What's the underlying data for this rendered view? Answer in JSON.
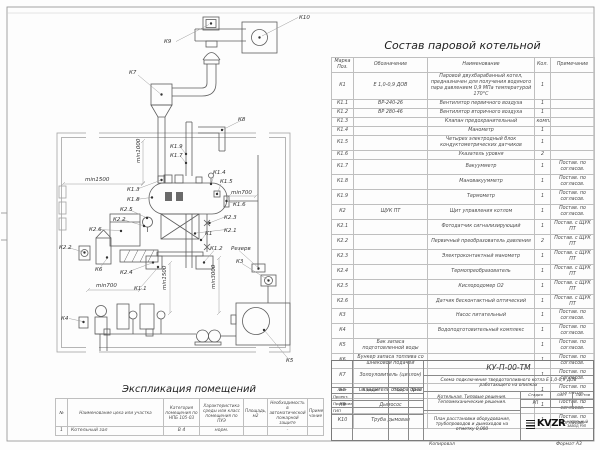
{
  "diagram": {
    "labels": {
      "k10": "К10",
      "k9": "К9",
      "k7": "К7",
      "k8": "К8",
      "k19": "К1.9",
      "k17": "К1.7",
      "k13": "К1.3",
      "k18": "К1.8",
      "k25": "К2.5",
      "k22a": "К2.2",
      "k14": "К1.4",
      "k15": "К1.5",
      "k16": "К1.6",
      "k23": "К2.3",
      "k21": "К2.1",
      "k1": "К1",
      "k26": "К2.6",
      "k22b": "К2.2",
      "k6": "К6",
      "k24": "К2.4",
      "k11": "К1.1",
      "k12": "К1.2",
      "rezerv": "Резерв",
      "k3": "К3",
      "k4": "К4",
      "k5": "К5",
      "dim_min1000": "min1000",
      "dim_min1500a": "min1500",
      "dim_min700a": "min700",
      "dim_min700b": "min700",
      "dim_min1500b": "min1500",
      "dim_min3000": "min3000"
    }
  },
  "composition": {
    "title": "Состав паровой котельной",
    "headers": {
      "pos": "Марка Поз.",
      "des": "Обозначение",
      "name": "Наименование",
      "qty": "Кол.",
      "note": "Примечание"
    },
    "rows": [
      {
        "pos": "К1",
        "des": "Е 1,0-0,9 ДОВ",
        "name": "Паровой двухбарабанный котел, предназначен для получения водяного пара давлением 0,9 МПа температурой 170°С",
        "qty": "1",
        "note": ""
      },
      {
        "pos": "К1.1",
        "des": "ВР-240-26",
        "name": "Вентилятор первичного воздуха",
        "qty": "1",
        "note": ""
      },
      {
        "pos": "К1.2",
        "des": "ВР 280-46",
        "name": "Вентилятор вторичного воздуха",
        "qty": "1",
        "note": ""
      },
      {
        "pos": "К1.3",
        "des": "",
        "name": "Клапан предохранительный",
        "qty": "компл.",
        "note": ""
      },
      {
        "pos": "К1.4",
        "des": "",
        "name": "Манометр",
        "qty": "1",
        "note": ""
      },
      {
        "pos": "К1.5",
        "des": "",
        "name": "Четырех электродный блок кондуктометрических датчиков",
        "qty": "1",
        "note": ""
      },
      {
        "pos": "К1.6",
        "des": "",
        "name": "Указатель уровня",
        "qty": "2",
        "note": ""
      },
      {
        "pos": "К1.7",
        "des": "",
        "name": "Вакуумметр",
        "qty": "1",
        "note": "Постав. по согласов."
      },
      {
        "pos": "К1.8",
        "des": "",
        "name": "Мановакуумметр",
        "qty": "1",
        "note": "Постав. по согласов."
      },
      {
        "pos": "К1.9",
        "des": "",
        "name": "Термометр",
        "qty": "1",
        "note": "Постав. по согласов."
      },
      {
        "pos": "К2",
        "des": "ЩУК ПТ",
        "name": "Щит управления котлом",
        "qty": "1",
        "note": "Постав. по согласов."
      },
      {
        "pos": "К2.1",
        "des": "",
        "name": "Фотодатчик сигнализирующий",
        "qty": "1",
        "note": "Постав. с ЩУК ПТ"
      },
      {
        "pos": "К2.2",
        "des": "",
        "name": "Первичный преобразователь давления",
        "qty": "2",
        "note": "Постав. с ЩУК ПТ"
      },
      {
        "pos": "К2.3",
        "des": "",
        "name": "Электроконтактный манометр",
        "qty": "1",
        "note": "Постав. с ЩУК ПТ"
      },
      {
        "pos": "К2.4",
        "des": "",
        "name": "Термопреобразователь",
        "qty": "1",
        "note": "Постав. с ЩУК ПТ"
      },
      {
        "pos": "К2.5",
        "des": "",
        "name": "Кислородомер О2",
        "qty": "1",
        "note": "Постав. с ЩУК ПТ"
      },
      {
        "pos": "К2.6",
        "des": "",
        "name": "Датчик бесконтактный оптический",
        "qty": "1",
        "note": "Постав. с ЩУК ПТ"
      },
      {
        "pos": "К3",
        "des": "",
        "name": "Насос питательный",
        "qty": "1",
        "note": "Постав. по согласов."
      },
      {
        "pos": "К4",
        "des": "",
        "name": "Водоподготовительный комплекс",
        "qty": "1",
        "note": "Постав. по согласов."
      },
      {
        "pos": "К5",
        "des": "Бак запаса подготовленной воды",
        "name": "",
        "qty": "1",
        "note": "Постав. по согласов."
      },
      {
        "pos": "К6",
        "des": "Бункер запаса топлива со шнековой подачей",
        "name": "",
        "qty": "1",
        "note": "Постав. по согласов."
      },
      {
        "pos": "К7",
        "des": "Золоуловитель (циклон)",
        "name": "",
        "qty": "1",
        "note": "Постав. по согласов."
      },
      {
        "pos": "К8",
        "des": "Охладитель отбора проб",
        "name": "",
        "qty": "1",
        "note": "Постав. по согласов."
      },
      {
        "pos": "К9",
        "des": "Дымосос",
        "name": "",
        "qty": "1",
        "note": "Постав. по согласов."
      },
      {
        "pos": "К10",
        "des": "Труба дымовая",
        "name": "",
        "qty": "1",
        "note": "Постав. по согласов."
      }
    ]
  },
  "explication": {
    "title": "Экспликация помещений",
    "headers": [
      "№",
      "Наименование цеха или участка",
      "Категория помещения по НПБ 105-03",
      "Характеристика среды или класс помещения по ПУЭ",
      "Площадь, м2",
      "Необходимость в автоматической пожарной защите",
      "Приме- чание"
    ],
    "row": {
      "num": "1",
      "name": "Котельный зал",
      "category": "В 4",
      "env": "норм.",
      "area": "",
      "fire": "-",
      "note": ""
    }
  },
  "titleblock": {
    "code": "КУ-П-00-ТМ",
    "doc_title": "Схема подключения твердотопливного котла Е 1,0-0,9 ДОВ работающего на опилках",
    "object": "Котельная. Типовые решения. Тепломеханические решения.",
    "sheet_name": "План расстановки оборудования, трубопроводов и дымоходов на отметку 0,000",
    "stage_label": "Стадия",
    "sheet_label": "Лист",
    "sheets_label": "Листов",
    "stage": "РП",
    "sheet": "-",
    "sheets": "-",
    "cols": {
      "list": "Лист",
      "ndoc": "N докум",
      "sign": "Подп.",
      "date": "Дата"
    },
    "roles": [
      "Проект.",
      "Проверил",
      "ГИП"
    ],
    "logo": "KVZR",
    "logo_sub1": "КОТЕЛЬНЫЙ",
    "logo_sub2": "ЗАВОД РЭП",
    "footer_left": "Копировал",
    "footer_right": "Формат А3"
  }
}
